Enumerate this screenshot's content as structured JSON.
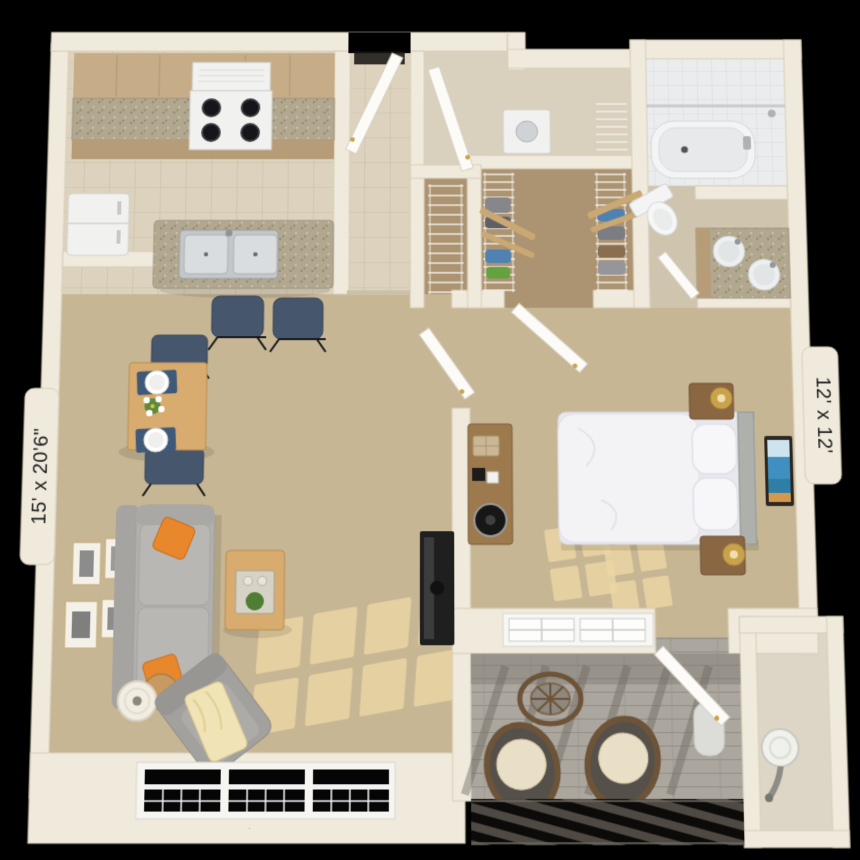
{
  "dimension_labels": {
    "living_area": "15' x 20'6\"",
    "bedroom": "12' x 12'"
  },
  "palette": {
    "background": "#000000",
    "wall": "#f0eadd",
    "wall_edge": "#d7cdb8",
    "carpet": "#c6b694",
    "closet_floor": "#ac9472",
    "sunlight": "#ecd7a4",
    "tile_kitchen": "#dcd2bd",
    "tile_kitchen_line": "#cbc0a8",
    "tile_bath": "#eaeced",
    "tile_bath_line": "#d6dadd",
    "bath_floor": "#cfc5ae",
    "granite": "#b2a88f",
    "cabinet_tan": "#c6ad87",
    "cabinet_tan_dark": "#b69d77",
    "appliance": "#f1f1ef",
    "appliance_edge": "#d2d2cc",
    "sofa_gray": "#b2b0ac",
    "pillow_orange": "#e8872b",
    "chair_navy": "#46566c",
    "wood": "#9c7a4e",
    "wood_light": "#d8ab6f",
    "bed_white": "#f3f3f6",
    "deck": "#aba69e",
    "deck_shadow": "#746f67",
    "wicker": "#6d5438",
    "cushion": "#e9dfc6",
    "tv_black": "#1f1f1f",
    "lamp_gold": "#c9a24c",
    "window_black": "#050505",
    "window_grid": "#f2f2f2",
    "label_text": "#1d1d1d"
  },
  "scene": {
    "rooms": [
      {
        "name": "kitchen",
        "items": [
          "upper-cabinets",
          "range-hood",
          "stove",
          "refrigerator",
          "island-counter",
          "double-sink",
          "bar-chair",
          "bar-chair"
        ]
      },
      {
        "name": "entry",
        "items": [
          "entry-door"
        ]
      },
      {
        "name": "utility-room",
        "items": [
          "utility-door",
          "washer",
          "wire-shelf"
        ]
      },
      {
        "name": "linen-closet",
        "items": [
          "wire-shelves"
        ]
      },
      {
        "name": "walk-in-closet",
        "items": [
          "wire-shelving",
          "clothes"
        ]
      },
      {
        "name": "bathroom",
        "items": [
          "bathtub",
          "shower-rod",
          "toilet",
          "double-sink-vanity",
          "bathroom-door"
        ]
      },
      {
        "name": "living-room",
        "items": [
          "dining-table",
          "dining-chair",
          "dining-chair",
          "sofa",
          "throw-pillow",
          "throw-pillow",
          "coffee-table",
          "armchair",
          "throw-blanket",
          "floor-lamp",
          "side-table",
          "wall-frames",
          "tv",
          "triple-window"
        ]
      },
      {
        "name": "bedroom",
        "items": [
          "bed",
          "pillow",
          "pillow",
          "nightstand",
          "nightstand",
          "table-lamp",
          "table-lamp",
          "desk",
          "wall-art",
          "double-window",
          "bedroom-door",
          "hall-door"
        ]
      },
      {
        "name": "balcony",
        "items": [
          "bistro-table",
          "wicker-chair",
          "wicker-chair",
          "balcony-door",
          "ac-tank",
          "railing"
        ]
      },
      {
        "name": "storage-closet",
        "items": [
          "water-heater"
        ]
      }
    ]
  }
}
